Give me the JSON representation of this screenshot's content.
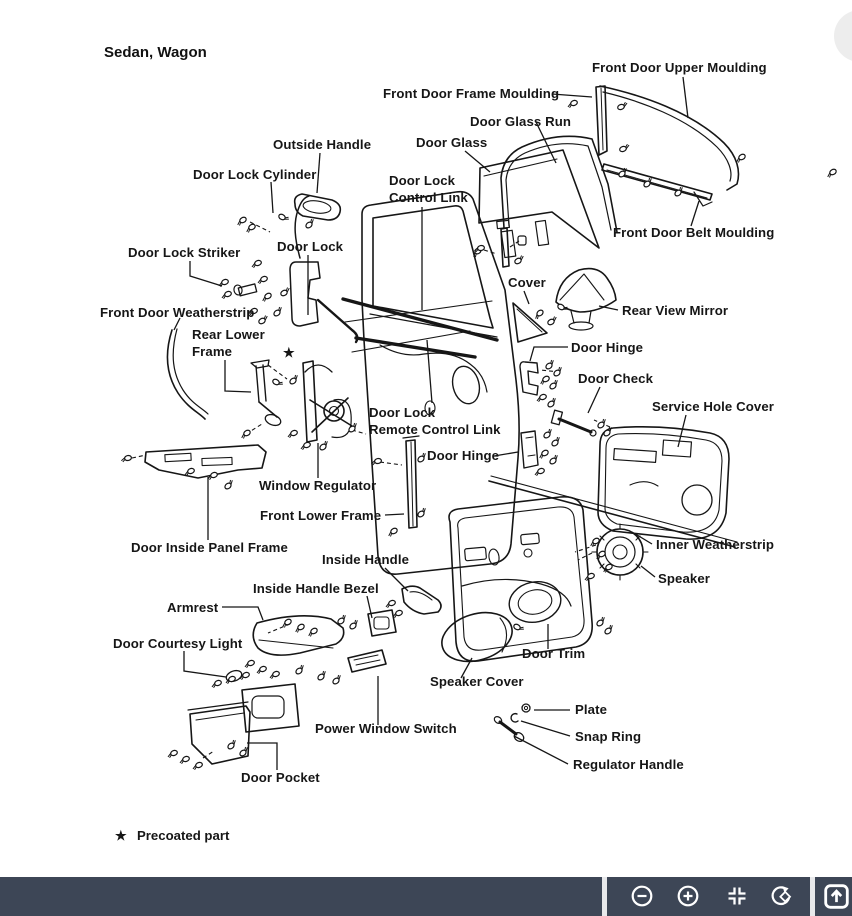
{
  "diagram": {
    "title": "Sedan, Wagon",
    "star_marker": "★",
    "footnote": {
      "symbol": "★",
      "text": "Precoated part"
    },
    "parts": [
      {
        "id": "front-door-upper-moulding",
        "label": "Front Door Upper Moulding"
      },
      {
        "id": "front-door-frame-moulding",
        "label": "Front Door Frame Moulding"
      },
      {
        "id": "door-glass-run",
        "label": "Door Glass Run"
      },
      {
        "id": "door-glass",
        "label": "Door Glass"
      },
      {
        "id": "outside-handle",
        "label": "Outside Handle"
      },
      {
        "id": "door-lock-cylinder",
        "label": "Door Lock Cylinder"
      },
      {
        "id": "door-lock-control-link",
        "label": "Door Lock Control Link",
        "line1": "Door Lock",
        "line2": "Control Link"
      },
      {
        "id": "front-door-belt-moulding",
        "label": "Front Door Belt Moulding"
      },
      {
        "id": "door-lock-striker",
        "label": "Door Lock Striker"
      },
      {
        "id": "door-lock",
        "label": "Door Lock"
      },
      {
        "id": "cover",
        "label": "Cover"
      },
      {
        "id": "rear-view-mirror",
        "label": "Rear View Mirror"
      },
      {
        "id": "front-door-weatherstrip",
        "label": "Front Door Weatherstrip"
      },
      {
        "id": "rear-lower-frame",
        "label": "Rear Lower Frame",
        "line1": "Rear Lower",
        "line2": "Frame"
      },
      {
        "id": "door-hinge-upper",
        "label": "Door Hinge"
      },
      {
        "id": "door-check",
        "label": "Door Check"
      },
      {
        "id": "service-hole-cover",
        "label": "Service Hole Cover"
      },
      {
        "id": "door-lock-remote-control-link",
        "label": "Door Lock Remote Control Link",
        "line1": "Door Lock",
        "line2": "Remote Control Link"
      },
      {
        "id": "door-hinge-lower",
        "label": "Door Hinge"
      },
      {
        "id": "window-regulator",
        "label": "Window Regulator"
      },
      {
        "id": "front-lower-frame",
        "label": "Front Lower Frame"
      },
      {
        "id": "door-inside-panel-frame",
        "label": "Door Inside Panel Frame"
      },
      {
        "id": "inside-handle",
        "label": "Inside Handle"
      },
      {
        "id": "inner-weatherstrip",
        "label": "Inner Weatherstrip"
      },
      {
        "id": "speaker",
        "label": "Speaker"
      },
      {
        "id": "inside-handle-bezel",
        "label": "Inside Handle Bezel"
      },
      {
        "id": "armrest",
        "label": "Armrest"
      },
      {
        "id": "door-courtesy-light",
        "label": "Door Courtesy Light"
      },
      {
        "id": "door-trim",
        "label": "Door Trim"
      },
      {
        "id": "speaker-cover",
        "label": "Speaker Cover"
      },
      {
        "id": "plate",
        "label": "Plate"
      },
      {
        "id": "power-window-switch",
        "label": "Power Window Switch"
      },
      {
        "id": "snap-ring",
        "label": "Snap Ring"
      },
      {
        "id": "regulator-handle",
        "label": "Regulator Handle"
      },
      {
        "id": "door-pocket",
        "label": "Door Pocket"
      }
    ]
  },
  "fab": {
    "name": "floating-button-partial",
    "color": "#ededed"
  },
  "toolbar": {
    "background": "#3d4656",
    "separator_color": "#e8e9eb",
    "icon_color": "#ffffff",
    "buttons": [
      {
        "name": "zoom-out",
        "icon": "minus-circle"
      },
      {
        "name": "zoom-in",
        "icon": "plus-circle"
      },
      {
        "name": "fit-to-screen",
        "icon": "compress-arrows"
      },
      {
        "name": "rotate",
        "icon": "rotate-arrow-diamond"
      },
      {
        "name": "open-external",
        "icon": "box-arrow-up"
      }
    ]
  }
}
